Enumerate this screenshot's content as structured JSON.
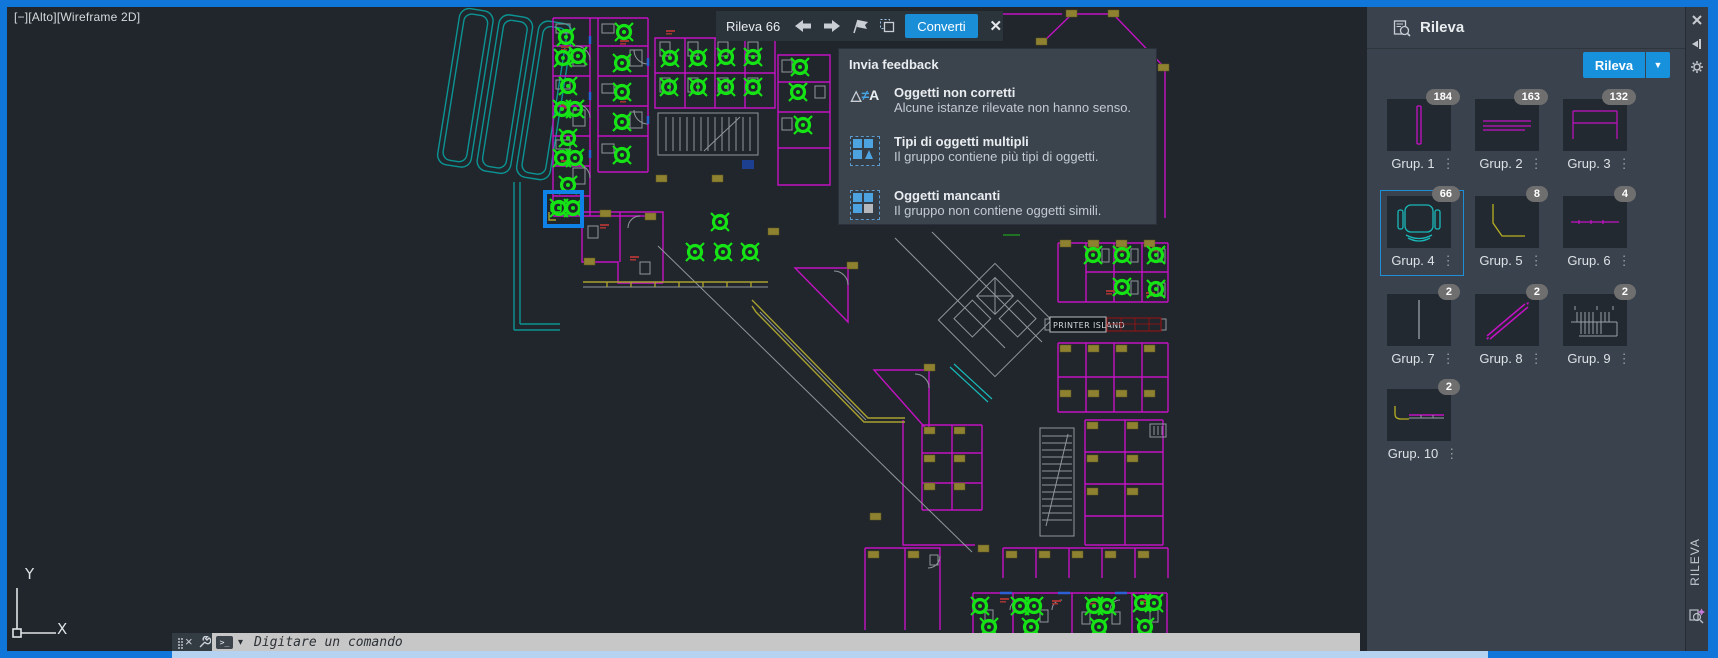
{
  "viewport": {
    "label": "[−][Alto][Wireframe 2D]"
  },
  "toolbar": {
    "title": "Rileva 66",
    "convert_label": "Converti",
    "close_label": "✕",
    "icons": [
      "back-arrow-icon",
      "forward-arrow-icon",
      "flag-icon",
      "multi-select-icon",
      "close-icon"
    ]
  },
  "feedback": {
    "title": "Invia feedback",
    "items": [
      {
        "icon": "triangle-notequal-a-icon",
        "title": "Oggetti non corretti",
        "desc": "Alcune istanze rilevate non hanno senso."
      },
      {
        "icon": "multiple-object-types-icon",
        "title": "Tipi di oggetti multipli",
        "desc": "Il gruppo contiene più tipi di oggetti."
      },
      {
        "icon": "missing-objects-icon",
        "title": "Oggetti mancanti",
        "desc": "Il gruppo non contiene oggetti simili."
      }
    ]
  },
  "panel": {
    "title": "Rileva",
    "detect_button": "Rileva",
    "caret": "▼",
    "side_tab": "RILEVA",
    "strip_icons": [
      "close-icon",
      "autohide-pin-icon",
      "properties-gear-icon",
      "detect-sparkle-icon"
    ],
    "groups": [
      {
        "label": "Grup. 1",
        "count": "184",
        "glyph": "vertical-double-line-magenta",
        "selected": false
      },
      {
        "label": "Grup. 2",
        "count": "163",
        "glyph": "horizontal-lines-magenta",
        "selected": false
      },
      {
        "label": "Grup. 3",
        "count": "132",
        "glyph": "table-outline-magenta",
        "selected": false
      },
      {
        "label": "Grup. 4",
        "count": "66",
        "glyph": "office-chair-cyan",
        "selected": true
      },
      {
        "label": "Grup. 5",
        "count": "8",
        "glyph": "corner-polyline-yellow",
        "selected": false
      },
      {
        "label": "Grup. 6",
        "count": "4",
        "glyph": "horizontal-line-magenta",
        "selected": false
      },
      {
        "label": "Grup. 7",
        "count": "2",
        "glyph": "vertical-line-gray",
        "selected": false
      },
      {
        "label": "Grup. 8",
        "count": "2",
        "glyph": "diagonal-double-line-magenta",
        "selected": false
      },
      {
        "label": "Grup. 9",
        "count": "2",
        "glyph": "hatched-counter-gray",
        "selected": false
      },
      {
        "label": "Grup. 10",
        "count": "2",
        "glyph": "profile-yellow-magenta",
        "selected": false
      }
    ],
    "menu_dots": "⋮"
  },
  "command_bar": {
    "prompt": "Digitare un comando",
    "close_label": "×",
    "icons": [
      "drag-grip-icon",
      "close-icon",
      "wrench-icon",
      "terminal-icon",
      "dropdown-caret-icon"
    ]
  },
  "ucs": {
    "y_label": "Y",
    "x_label": "X"
  },
  "plan": {
    "printer_island_label": "PRINTER ISLAND",
    "colors": {
      "walls_magenta": "#c312c3",
      "detected_green": "#15e315",
      "structure_teal": "#0c9494",
      "details_gray": "#8f969c",
      "tags_olive": "#8e8230",
      "labels_red": "#a23434",
      "selection_blue": "#0f82e8",
      "canvas_bg": "#20262b",
      "accent_blue": "#1791dc",
      "window_border": "#1176d9",
      "panel_bg": "#3a424d",
      "scrollbar": "#b5d2f0"
    },
    "chairs": [
      [
        566,
        37
      ],
      [
        563,
        58
      ],
      [
        578,
        56
      ],
      [
        624,
        32
      ],
      [
        622,
        63
      ],
      [
        568,
        86
      ],
      [
        562,
        109
      ],
      [
        575,
        109
      ],
      [
        568,
        138
      ],
      [
        562,
        158
      ],
      [
        575,
        158
      ],
      [
        568,
        185
      ],
      [
        559,
        208
      ],
      [
        573,
        208
      ],
      [
        622,
        92
      ],
      [
        622,
        122
      ],
      [
        622,
        155
      ],
      [
        670,
        58
      ],
      [
        698,
        58
      ],
      [
        726,
        57
      ],
      [
        753,
        57
      ],
      [
        669,
        87
      ],
      [
        698,
        87
      ],
      [
        726,
        87
      ],
      [
        753,
        87
      ],
      [
        800,
        67
      ],
      [
        798,
        92
      ],
      [
        803,
        125
      ],
      [
        720,
        222
      ],
      [
        695,
        252
      ],
      [
        723,
        252
      ],
      [
        750,
        252
      ],
      [
        1093,
        255
      ],
      [
        1122,
        255
      ],
      [
        1156,
        255
      ],
      [
        1122,
        287
      ],
      [
        1156,
        289
      ],
      [
        980,
        606
      ],
      [
        1020,
        606
      ],
      [
        1034,
        606
      ],
      [
        1094,
        606
      ],
      [
        1107,
        606
      ],
      [
        1142,
        603
      ],
      [
        1154,
        603
      ],
      [
        989,
        627
      ],
      [
        1031,
        627
      ],
      [
        1099,
        627
      ],
      [
        1145,
        627
      ]
    ],
    "tags": [
      [
        584,
        258
      ],
      [
        645,
        213
      ],
      [
        600,
        210
      ],
      [
        656,
        175
      ],
      [
        712,
        175
      ],
      [
        768,
        228
      ],
      [
        847,
        262
      ],
      [
        924,
        364
      ],
      [
        1036,
        38
      ],
      [
        1066,
        10
      ],
      [
        1108,
        10
      ],
      [
        1158,
        64
      ],
      [
        1060,
        240
      ],
      [
        1088,
        240
      ],
      [
        1116,
        240
      ],
      [
        1144,
        240
      ],
      [
        1060,
        345
      ],
      [
        1088,
        345
      ],
      [
        1116,
        345
      ],
      [
        1144,
        345
      ],
      [
        1060,
        390
      ],
      [
        1088,
        390
      ],
      [
        1116,
        390
      ],
      [
        1144,
        390
      ],
      [
        1087,
        422
      ],
      [
        1127,
        422
      ],
      [
        1087,
        455
      ],
      [
        1127,
        455
      ],
      [
        1087,
        488
      ],
      [
        1127,
        488
      ],
      [
        924,
        427
      ],
      [
        954,
        427
      ],
      [
        924,
        455
      ],
      [
        954,
        455
      ],
      [
        924,
        483
      ],
      [
        954,
        483
      ],
      [
        868,
        551
      ],
      [
        908,
        551
      ],
      [
        978,
        545
      ],
      [
        870,
        513
      ],
      [
        1006,
        551
      ],
      [
        1039,
        551
      ],
      [
        1072,
        551
      ],
      [
        1105,
        551
      ],
      [
        1138,
        551
      ]
    ],
    "red_marks": [
      [
        561,
        46
      ],
      [
        561,
        104
      ],
      [
        561,
        160
      ],
      [
        620,
        40
      ],
      [
        620,
        98
      ],
      [
        600,
        224
      ],
      [
        630,
        256
      ],
      [
        666,
        30
      ],
      [
        1090,
        247
      ],
      [
        1119,
        247
      ],
      [
        1152,
        247
      ],
      [
        1106,
        290
      ],
      [
        1146,
        292
      ],
      [
        1000,
        598
      ],
      [
        1052,
        600
      ],
      [
        1090,
        600
      ],
      [
        1140,
        600
      ]
    ],
    "desks": [
      [
        556,
        24,
        14,
        9
      ],
      [
        573,
        50,
        12,
        16
      ],
      [
        556,
        80,
        14,
        9
      ],
      [
        573,
        110,
        12,
        16
      ],
      [
        556,
        140,
        14,
        9
      ],
      [
        573,
        168,
        12,
        16
      ],
      [
        602,
        24,
        12,
        9
      ],
      [
        630,
        50,
        12,
        16
      ],
      [
        602,
        84,
        12,
        9
      ],
      [
        630,
        112,
        12,
        16
      ],
      [
        602,
        144,
        12,
        9
      ],
      [
        660,
        42,
        10,
        14
      ],
      [
        688,
        42,
        10,
        14
      ],
      [
        718,
        42,
        10,
        14
      ],
      [
        748,
        42,
        10,
        14
      ],
      [
        660,
        78,
        10,
        14
      ],
      [
        688,
        78,
        10,
        14
      ],
      [
        718,
        78,
        10,
        14
      ],
      [
        748,
        78,
        10,
        14
      ],
      [
        782,
        60,
        10,
        12
      ],
      [
        815,
        86,
        10,
        12
      ],
      [
        782,
        118,
        10,
        12
      ],
      [
        588,
        226,
        10,
        12
      ],
      [
        640,
        262,
        10,
        12
      ],
      [
        1102,
        249,
        7,
        13
      ],
      [
        1131,
        249,
        7,
        13
      ],
      [
        1158,
        249,
        7,
        13
      ],
      [
        1131,
        281,
        7,
        13
      ],
      [
        1158,
        283,
        7,
        13
      ],
      [
        985,
        610,
        8,
        12
      ],
      [
        1040,
        610,
        8,
        12
      ],
      [
        1082,
        612,
        8,
        12
      ],
      [
        1112,
        612,
        8,
        12
      ],
      [
        1150,
        610,
        8,
        12
      ],
      [
        930,
        555,
        8,
        10
      ]
    ]
  }
}
